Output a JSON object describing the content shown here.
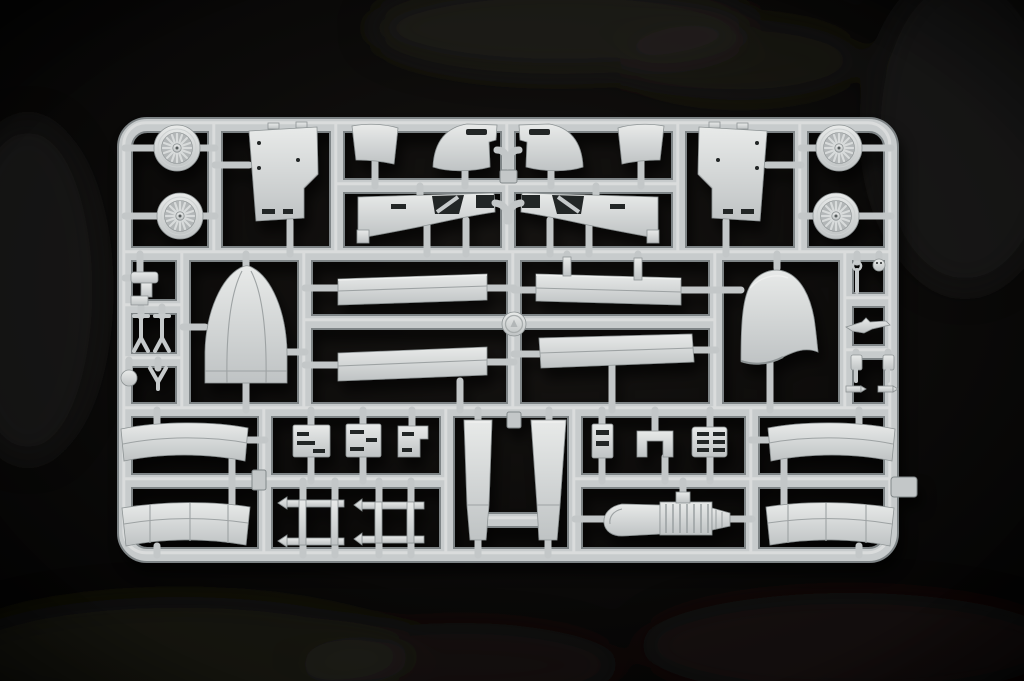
{
  "scene": {
    "type": "photograph",
    "subject": "Light gray injection-molded plastic model kit sprue (parts tree) with aircraft model parts",
    "background": "black studio backdrop with faint soft shadows",
    "plastic_color_name": "light gray",
    "visible_text": "none legible",
    "layout": "rounded rectangular sprue frame divided by runners into three horizontal bands of parts"
  },
  "palette": {
    "background": "#060505",
    "background_glow": "#1d1a17",
    "plastic_light": "#e9ebea",
    "plastic_mid": "#c7cbcc",
    "plastic_dark": "#7e8486",
    "hole_dark": "#232526"
  },
  "sprue": {
    "grid_rows": 3,
    "medallion": "embossed circular manufacturer medallion at sprue center",
    "parts_inventory": [
      {
        "name": "spoked wheel",
        "count": 4,
        "location": "top band corners"
      },
      {
        "name": "fuselage side panel",
        "count": 2,
        "location": "top band, mirrored pair"
      },
      {
        "name": "small flap",
        "count": 2,
        "location": "top band center"
      },
      {
        "name": "curved cowl flap",
        "count": 2,
        "location": "top band center"
      },
      {
        "name": "wing root fairing",
        "count": 2,
        "location": "top band center, mirrored pair"
      },
      {
        "name": "landing gear strut set",
        "count": 1,
        "location": "middle band far left"
      },
      {
        "name": "nose cone fairing",
        "count": 1,
        "location": "middle band left"
      },
      {
        "name": "wing skin panel",
        "count": 4,
        "location": "middle band center"
      },
      {
        "name": "maker medallion",
        "count": 1,
        "location": "middle band center"
      },
      {
        "name": "engine cowling hood",
        "count": 1,
        "location": "middle band right"
      },
      {
        "name": "small detail set",
        "count": 1,
        "location": "middle band far right"
      },
      {
        "name": "curved fuselage panel",
        "count": 4,
        "location": "bottom band corners, stacked pairs"
      },
      {
        "name": "engine block",
        "count": 3,
        "location": "bottom band left"
      },
      {
        "name": "ladder frame",
        "count": 2,
        "location": "bottom band left"
      },
      {
        "name": "stabilizer blade",
        "count": 2,
        "location": "bottom band center"
      },
      {
        "name": "slotted strip",
        "count": 1,
        "location": "bottom band center-right"
      },
      {
        "name": "u-bracket",
        "count": 1,
        "location": "bottom band center-right"
      },
      {
        "name": "louvered panel",
        "count": 1,
        "location": "bottom band center-right"
      },
      {
        "name": "engine with exhaust pipe",
        "count": 1,
        "location": "bottom band center-right"
      },
      {
        "name": "sprue gate tab",
        "count": 1,
        "location": "right edge of frame"
      }
    ]
  },
  "labels": {
    "photo": "photograph of a model kit sprue on black background",
    "sprue": "light gray plastic sprue frame",
    "frame": "sprue runner frame",
    "top-left-parts": "top band left parts: wheels, fuselage panel, flaps, wing fairing",
    "top-right-parts": "top band right parts, mirrored set",
    "gear-cluster": "landing gear strut parts cluster",
    "nose-cone": "nose cone fairing part",
    "wing-panels": "wing skin panels",
    "medallion": "embossed maker medallion",
    "engine-cowling": "engine cowling hood part",
    "detail-cluster": "small detail parts cluster",
    "bottom-left-panels": "curved fuselage panels, bottom left",
    "bottom-right-panels": "curved fuselage panels, bottom right",
    "engine-blocks": "small engine block parts",
    "ladder-frames": "ladder frame parts",
    "stabilizer-blades": "stabilizer blade parts",
    "strip-part": "slotted strip part",
    "u-bracket": "u-bracket part",
    "louver-panel": "louvered panel part",
    "engine-assembly": "engine with curved exhaust pipe",
    "gate-tab": "sprue gate tab",
    "wheel": "spoked wheel part"
  }
}
